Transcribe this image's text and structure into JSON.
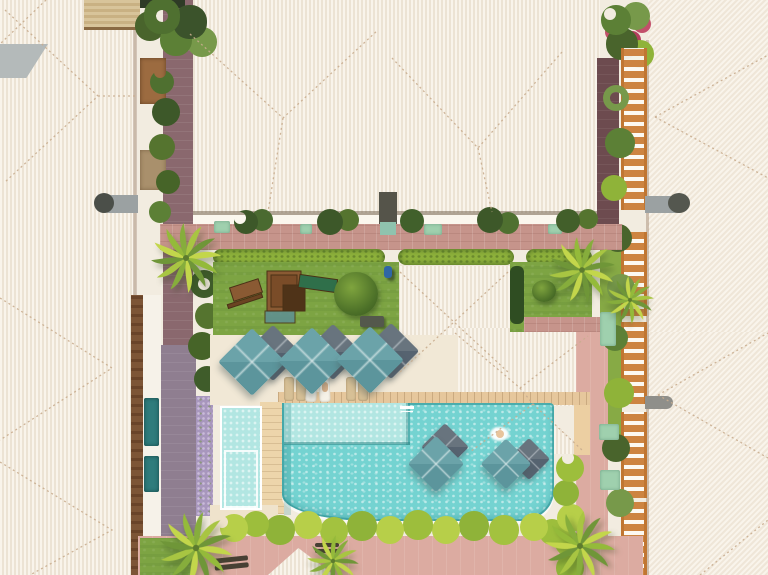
{
  "scene": {
    "type": "aerial-photo",
    "subject": "Top-down drone view of a resort condominium: white tiled rooftops around a central courtyard with lawn, wooden playground, sun deck with square parasols, loungers, a turquoise swimming pool with one swimmer, children's pool, terracotta garden paths, hedges and palm trees"
  },
  "labels": {
    "left_buildings": "White tiled rooftops of the left residence row",
    "top_buildings": "White tiled rooftop of the upper residence block",
    "right_buildings": "White tiled rooftops of the right residence row",
    "clubhouse": "Central building with white hip roof",
    "courtyard_lawn": "Courtyard lawn with playground",
    "playground": "Wooden playground tower with green slide and picnic table",
    "pool": "Turquoise swimming pool with swimmer",
    "kids_pool": "Children's pool",
    "sun_deck": "Pool sun deck with parasols and loungers",
    "parasols": "Square teal and grey parasols",
    "garden_paths": "Terracotta and mauve garden paths",
    "palms": "Palm trees",
    "pergola": "Orange timber pergolas along the right walkway",
    "swimmer": "Person swimming in the pool",
    "person_on_lawn": "Person walking on the lawn"
  },
  "counts": {
    "teal_parasols_deck": 3,
    "grey_parasols_deck": 3,
    "teal_parasols_pool": 2,
    "grey_parasols_pool": 2,
    "sun_loungers": 8,
    "palm_trees": 6,
    "swimmers": 1
  },
  "palette": {
    "roof_light": "#f8f3ea",
    "roof_shade": "#ece3d4",
    "ridge_line": "#c9ad8f",
    "wall_white": "#fbf7ee",
    "path_pink": "#dcaba1",
    "path_rose": "#c6948b",
    "path_maroon": "#6d4b4f",
    "path_mauve": "#8d7b8c",
    "lawn_green": "#7da443",
    "hedge_green": "#8fb23c",
    "shrub_lime": "#b7cf49",
    "dark_foliage": "#3d5829",
    "palm_light": "#c3d64b",
    "pool_teal": "#74d3d1",
    "pool_shallow": "#b9e9e4",
    "pool_edge": "#2a8f92",
    "kids_pool_water": "#b2e6e2",
    "umbrella_teal": "#67a0a6",
    "umbrella_grey": "#5f6e79",
    "deck_cream": "#f1e8d6",
    "deck_sand": "#eccfa2",
    "wood_brown": "#8a5a33",
    "pergola_orange": "#cd8441",
    "lavender": "#a897bd"
  }
}
